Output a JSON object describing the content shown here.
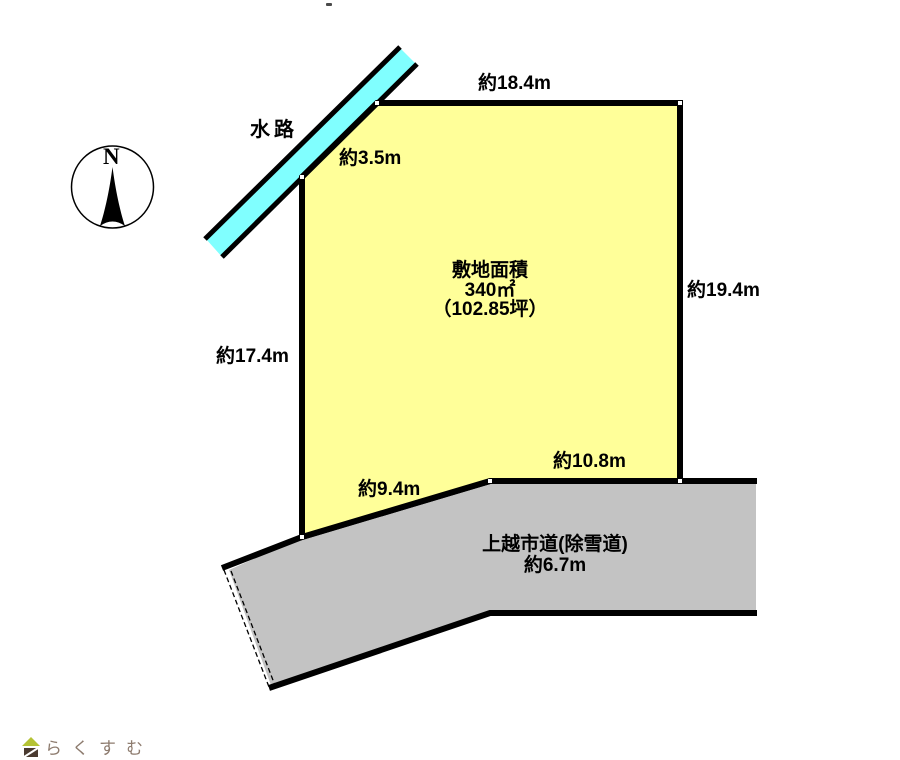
{
  "diagram": {
    "compass": {
      "label": "N"
    },
    "waterway": {
      "label": "水路"
    },
    "plot": {
      "area_title": "敷地面積",
      "area_value": "340㎡",
      "area_tsubo": "（102.85坪）",
      "side_top": "約18.4m",
      "side_right": "約19.4m",
      "side_left": "約17.4m",
      "side_upper_left": "約3.5m",
      "side_bottom": "約10.8m",
      "side_bottom_left": "約9.4m"
    },
    "road": {
      "name": "上越市道(除雪道)",
      "width_label": "約6.7m"
    },
    "colors": {
      "plot_fill": "#ffff99",
      "waterway_fill": "#80ffff",
      "road_fill": "#c3c3c3",
      "outline": "#000000",
      "logo_roof": "#b5c335",
      "logo_body": "#4a3a30",
      "logo_text": "#8d7b6e"
    }
  },
  "footer": {
    "brand": "らくすむ"
  }
}
